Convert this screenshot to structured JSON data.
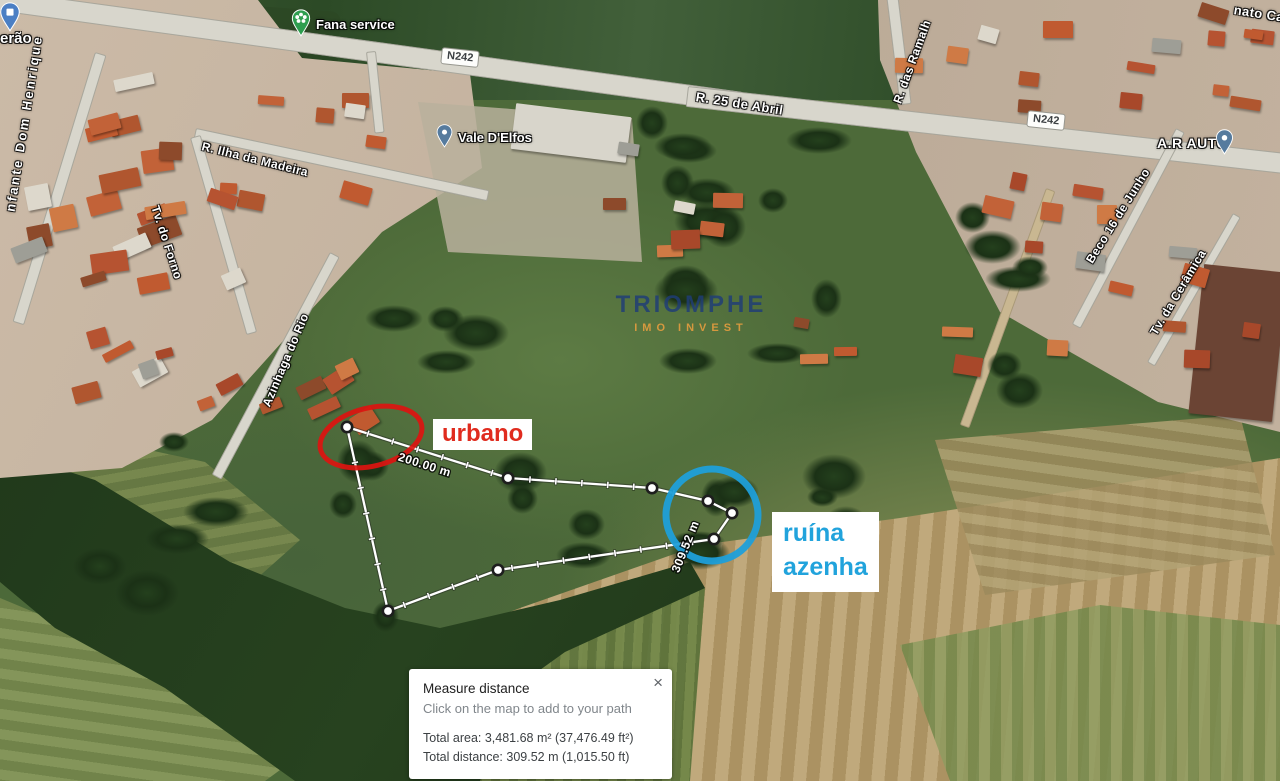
{
  "map": {
    "shield_label": "N242",
    "roads": {
      "r25_abril": "R. 25 de Abril",
      "ramalheiras": "R. das Ramalh",
      "ilha_madeira": "R. Ilha da Madeira",
      "tv_forno": "Tv. do Forno",
      "azinhaga_rio": "Azinhaga do Rio",
      "infante": "nfante Dom Henrique",
      "beco_junho": "Beco 16 de Junho",
      "tv_ceramica": "Tv. da Cerâmica",
      "corner_fragment": "nato Ca"
    },
    "pois": {
      "fana_service": "Fana service",
      "vale_delfos": "Vale D'Elfos",
      "ar_auto": "A.R AUTO",
      "erao": "erão"
    }
  },
  "watermark": {
    "line1": "TRIOMPHE",
    "line2": "IMO INVEST",
    "color1": "#1f3d78",
    "color2": "#dd9b3f"
  },
  "annotations": {
    "urbano_label": "urbano",
    "urbano_color": "#e02b1e",
    "red_color": "#dd1410",
    "ruina_line1": "ruína",
    "ruina_line2": "azenha",
    "ruina_color": "#21a3dc",
    "blue_color": "#1f9fd9",
    "red_ellipse": {
      "cx": 371,
      "cy": 437,
      "rx": 52,
      "ry": 29,
      "angle": -14
    },
    "blue_circle": {
      "cx": 712,
      "cy": 515,
      "r": 46
    }
  },
  "measurement": {
    "segment_label": "200.00 m",
    "total_label": "309.52 m",
    "points": [
      [
        347,
        427
      ],
      [
        508,
        478
      ],
      [
        652,
        488
      ],
      [
        708,
        501
      ],
      [
        732,
        513
      ],
      [
        714,
        539
      ],
      [
        498,
        570
      ],
      [
        388,
        611
      ]
    ]
  },
  "measure_panel": {
    "title": "Measure distance",
    "subtitle": "Click on the map to add to your path",
    "total_area": "Total area: 3,481.68 m² (37,476.49 ft²)",
    "total_distance": "Total distance: 309.52 m (1,015.50 ft)",
    "close_label": "×"
  }
}
